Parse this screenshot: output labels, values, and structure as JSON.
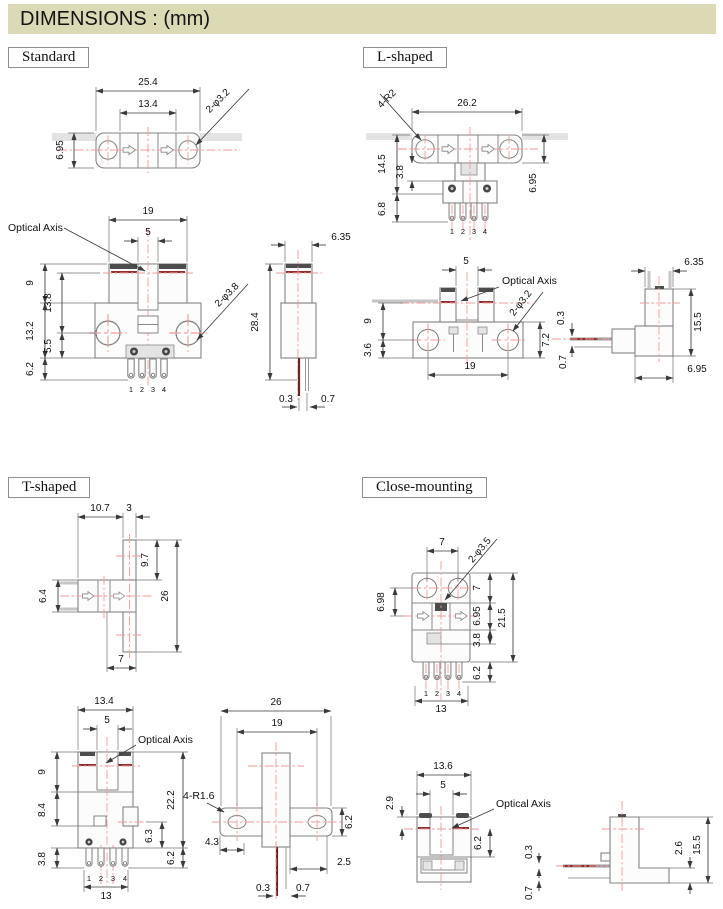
{
  "header": {
    "title": "DIMENSIONS : (mm)"
  },
  "sections": {
    "standard": {
      "label": "Standard",
      "top": {
        "w": "25.4",
        "iw": "13.4",
        "h": "6.95",
        "holes": "2-φ3.2"
      },
      "front": {
        "w": "19",
        "slot": "5",
        "axis": "Optical Axis",
        "a": "9",
        "b": "13.8",
        "c": "13.2",
        "d": "5.5",
        "e": "6.2",
        "holes": "2-φ3.8",
        "pins": [
          "1",
          "2",
          "3",
          "4"
        ]
      },
      "side": {
        "w": "6.35",
        "h": "28.4",
        "t1": "0.3",
        "t2": "0.7"
      }
    },
    "l_shaped": {
      "label": "L-shaped",
      "top": {
        "r": "4-R2",
        "w": "26.2",
        "a": "14.5",
        "b": "3.8",
        "c": "6.8",
        "h": "6.95",
        "pins": [
          "1",
          "2",
          "3",
          "4"
        ]
      },
      "front": {
        "slot": "5",
        "axis": "Optical Axis",
        "holes": "2-φ3.2",
        "a": "9",
        "b": "3.6",
        "w": "19",
        "c": "7.2",
        "t1": "0.3",
        "t2": "0.7"
      },
      "side": {
        "w": "6.35",
        "h": "15.5",
        "bw": "6.95"
      }
    },
    "t_shaped": {
      "label": "T-shaped",
      "top": {
        "a": "10.7",
        "b": "3",
        "c": "9.7",
        "d": "26",
        "e": "6.4",
        "f": "7"
      },
      "front": {
        "w": "13.4",
        "slot": "5",
        "axis": "Optical Axis",
        "a": "9",
        "b": "8.4",
        "c": "3.8",
        "d": "22.2",
        "e": "6.3",
        "f": "6.2",
        "bw": "13",
        "pins": [
          "1",
          "2",
          "3",
          "4"
        ]
      },
      "side": {
        "w": "26",
        "iw": "19",
        "r": "4-R1.6",
        "a": "4.3",
        "b": "6.2",
        "c": "2.5",
        "t1": "0.3",
        "t2": "0.7"
      }
    },
    "close_mounting": {
      "label": "Close-mounting",
      "top": {
        "a": "7",
        "holes": "2-φ3.5",
        "b": "6.98",
        "r1": "7",
        "r2": "6.95",
        "r3": "3.8",
        "r4": "6.2",
        "r5": "21.5",
        "bw": "13",
        "pins": [
          "1",
          "2",
          "3",
          "4"
        ]
      },
      "front": {
        "w": "13.6",
        "slot": "5",
        "axis": "Optical Axis",
        "a": "2.9",
        "b": "6.2"
      },
      "side": {
        "t1": "0.3",
        "t2": "0.7",
        "a": "2.6",
        "h": "15.5"
      }
    }
  }
}
